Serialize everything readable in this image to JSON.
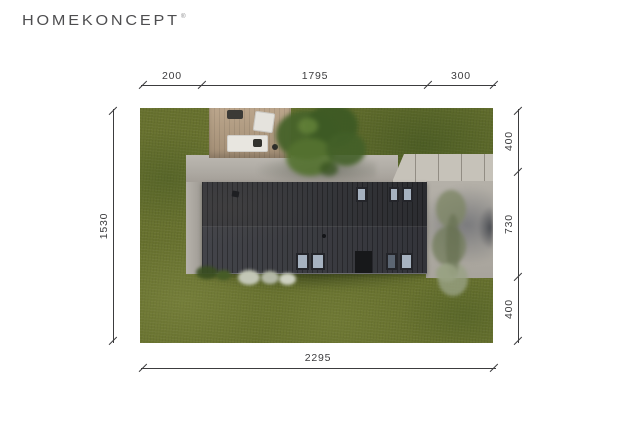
{
  "logo": {
    "brand": "HOMEKONCEPT",
    "registered_mark": "®"
  },
  "plan": {
    "dimensions_cm": {
      "top": [
        "200",
        "1795",
        "300"
      ],
      "left": [
        "1530"
      ],
      "right": [
        "400",
        "730",
        "400"
      ],
      "bottom": [
        "2295"
      ]
    }
  },
  "scene": {
    "type": "aerial-site-plan-render",
    "elements": [
      "lawn",
      "dark-flat-roof-house",
      "roof-windows",
      "wooden-deck-with-furniture",
      "concrete-apron",
      "slab-driveway",
      "paved-parking",
      "trees",
      "shrubs"
    ],
    "colors": {
      "grass": "#67712e",
      "roof_dark": "#2b2c30",
      "roof_light": "#43444a",
      "paving": "#aeaaa3",
      "slab": "#c6c2b9",
      "deck_wood": "#b59e82",
      "window_glass": "#a6b2c0",
      "canopy_green": "#47632a",
      "dimension_ink": "#3c3c3e"
    }
  }
}
